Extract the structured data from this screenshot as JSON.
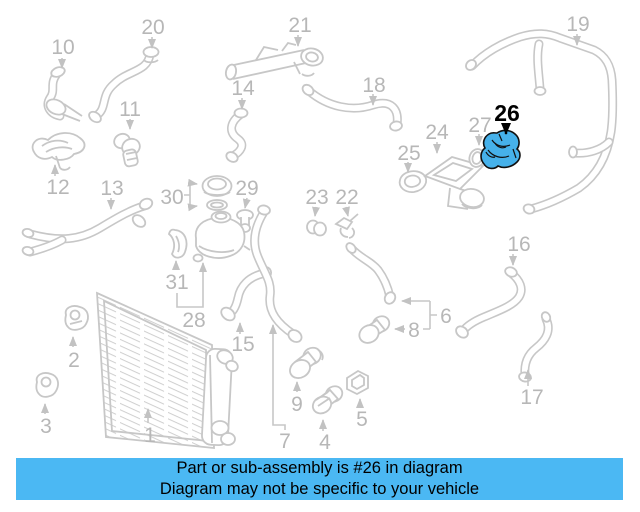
{
  "banner": {
    "line1": "Part or sub-assembly is #26 in diagram",
    "line2": "Diagram may not be specific to your vehicle",
    "background_color": "#4bb8f3",
    "text_color": "#000000"
  },
  "diagram": {
    "type": "parts-diagram",
    "highlighted_part": "26",
    "highlight_color": "#46b1ea",
    "line_color": "#c7c7c7",
    "label_color": "#b7b7b7",
    "labels": [
      {
        "text": "1"
      },
      {
        "text": "2"
      },
      {
        "text": "3"
      },
      {
        "text": "4"
      },
      {
        "text": "5"
      },
      {
        "text": "6"
      },
      {
        "text": "7"
      },
      {
        "text": "8"
      },
      {
        "text": "9"
      },
      {
        "text": "10"
      },
      {
        "text": "11"
      },
      {
        "text": "12"
      },
      {
        "text": "13"
      },
      {
        "text": "14"
      },
      {
        "text": "15"
      },
      {
        "text": "16"
      },
      {
        "text": "17"
      },
      {
        "text": "18"
      },
      {
        "text": "19"
      },
      {
        "text": "20"
      },
      {
        "text": "21"
      },
      {
        "text": "22"
      },
      {
        "text": "23"
      },
      {
        "text": "24"
      },
      {
        "text": "25"
      },
      {
        "text": "26"
      },
      {
        "text": "27"
      },
      {
        "text": "28"
      },
      {
        "text": "29"
      },
      {
        "text": "30"
      },
      {
        "text": "31"
      }
    ]
  }
}
